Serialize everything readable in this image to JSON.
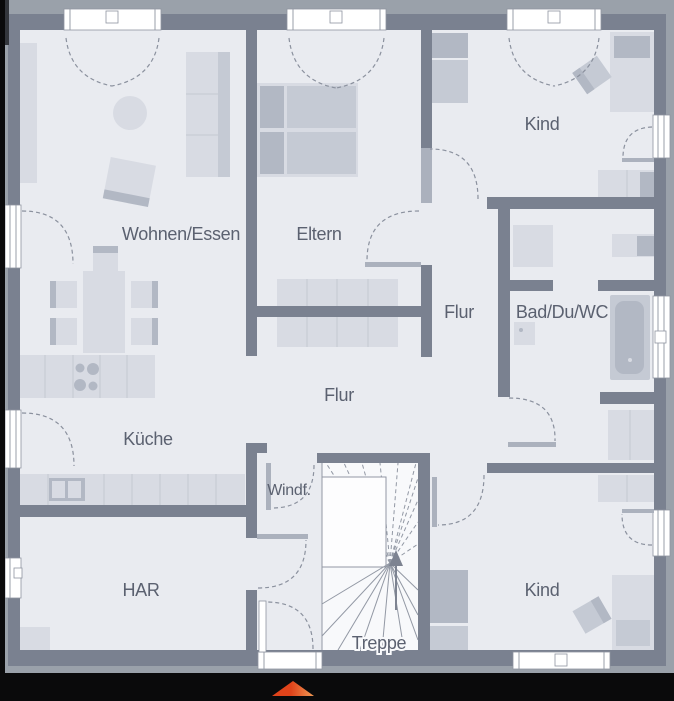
{
  "labels": {
    "wohnenEssen": "Wohnen/Essen",
    "eltern": "Eltern",
    "kindTop": "Kind",
    "flurUpper": "Flur",
    "bad": "Bad/Du/WC",
    "kueche": "Küche",
    "flurLower": "Flur",
    "windfang": "Windf.",
    "har": "HAR",
    "treppe": "Treppe",
    "kindBottom": "Kind"
  },
  "stairs": {
    "label": "Treppe",
    "direction": "up",
    "arrow_icon": "▲"
  },
  "entrance_marker": {
    "icon": "triangle-up",
    "color": "#e85320"
  },
  "colors": {
    "outside": "#9aa1aa",
    "wall": "#7a8190",
    "wallLight": "#abb1bd",
    "floor": "#e9ebf0",
    "stairBg": "#f8f9fb",
    "furnLight": "#d8dbe3",
    "furnMid": "#c5cad4",
    "furnDark": "#b2b8c4",
    "window": "#ffffff",
    "frame": "#8f95a1",
    "cellLine": "#c3c8d2",
    "dash": "#8b919e",
    "tread": "#9298a4",
    "text": "#5b6170",
    "black": "#0a0a0b",
    "darkCorner": "#33363c",
    "accent": "#e85320",
    "accentLight": "#f09a55"
  }
}
